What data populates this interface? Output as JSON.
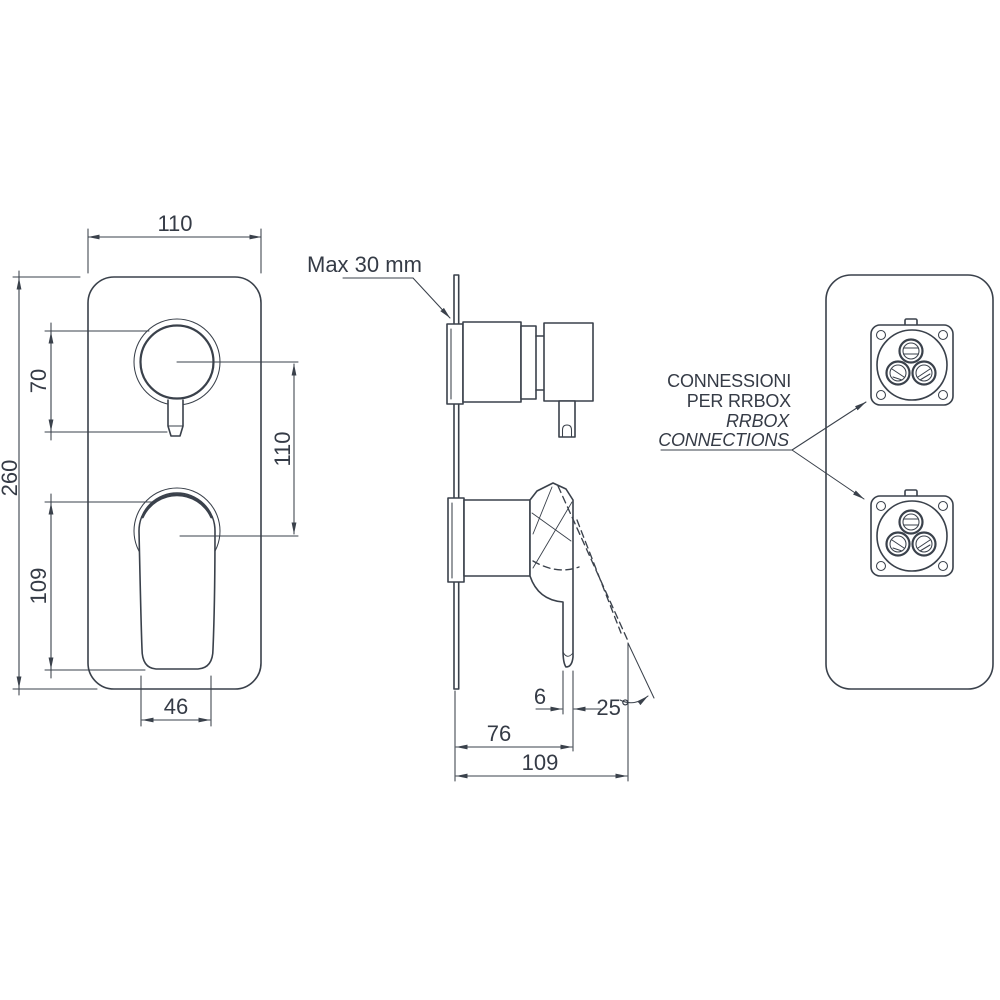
{
  "drawing_title": "Concealed shower mixer technical drawing",
  "colors": {
    "background": "#ffffff",
    "line": "#3a414b",
    "text": "#353b46"
  },
  "front_view": {
    "width": "110",
    "height": "260",
    "knob_height": "70",
    "lever_height": "109",
    "centers_distance": "110",
    "lever_width": "46"
  },
  "side_view": {
    "wall_note": "Max 30 mm",
    "lever_offset": "6",
    "lever_angle": "25°",
    "depth_body": "76",
    "depth_total": "109"
  },
  "back_view": {
    "note_line1": "CONNESSIONI",
    "note_line2": "PER RRBOX",
    "note_line3": "RRBOX",
    "note_line4": "CONNECTIONS"
  }
}
